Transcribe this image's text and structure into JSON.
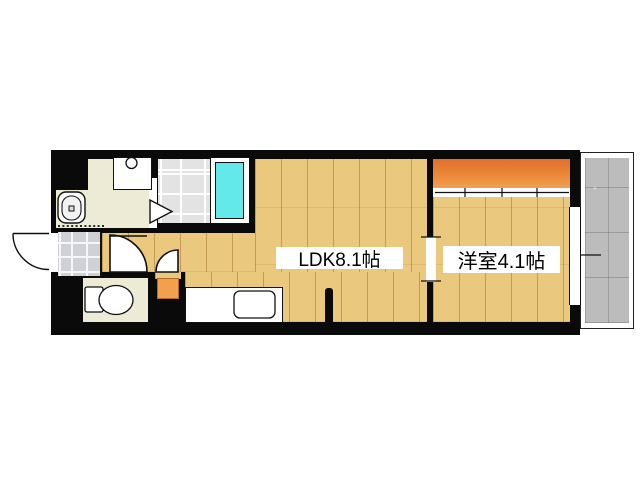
{
  "floor_plan": {
    "type": "apartment-floorplan",
    "room_labels": {
      "ldk": "LDK8.1帖",
      "western_room": "洋室4.1帖"
    },
    "rooms": [
      {
        "name": "ldk",
        "label": "LDK8.1帖",
        "floor": "wood"
      },
      {
        "name": "western-room",
        "label": "洋室4.1帖",
        "floor": "wood"
      },
      {
        "name": "washroom",
        "floor": "mat"
      },
      {
        "name": "bathroom",
        "floor": "tile-grid"
      },
      {
        "name": "toilet-room",
        "floor": "mat"
      },
      {
        "name": "entrance",
        "floor": "stone-tile"
      },
      {
        "name": "balcony",
        "floor": "concrete"
      }
    ],
    "fixtures": [
      "bathtub",
      "washbasin",
      "washing-machine-space",
      "toilet",
      "kitchen-counter",
      "kitchen-sink",
      "entrance-door",
      "hall-door",
      "toilet-door",
      "bathroom-folding-door",
      "closet-sliding-door",
      "window",
      "utility-box"
    ],
    "colors": {
      "wall": "#0a0a0a",
      "wood_floor": "#eac87e",
      "closet_orange": "#ea8838",
      "utility_orange": "#f2a04c",
      "bathtub_cyan": "#63e9e9",
      "mat_floor": "#edebd5",
      "entrance_tile": "#d0d0d7",
      "bathroom_tile": "#e3e3e3",
      "balcony_concrete": "#bcbcbc",
      "label_bg": "#ffffff",
      "label_text": "#000000"
    }
  }
}
